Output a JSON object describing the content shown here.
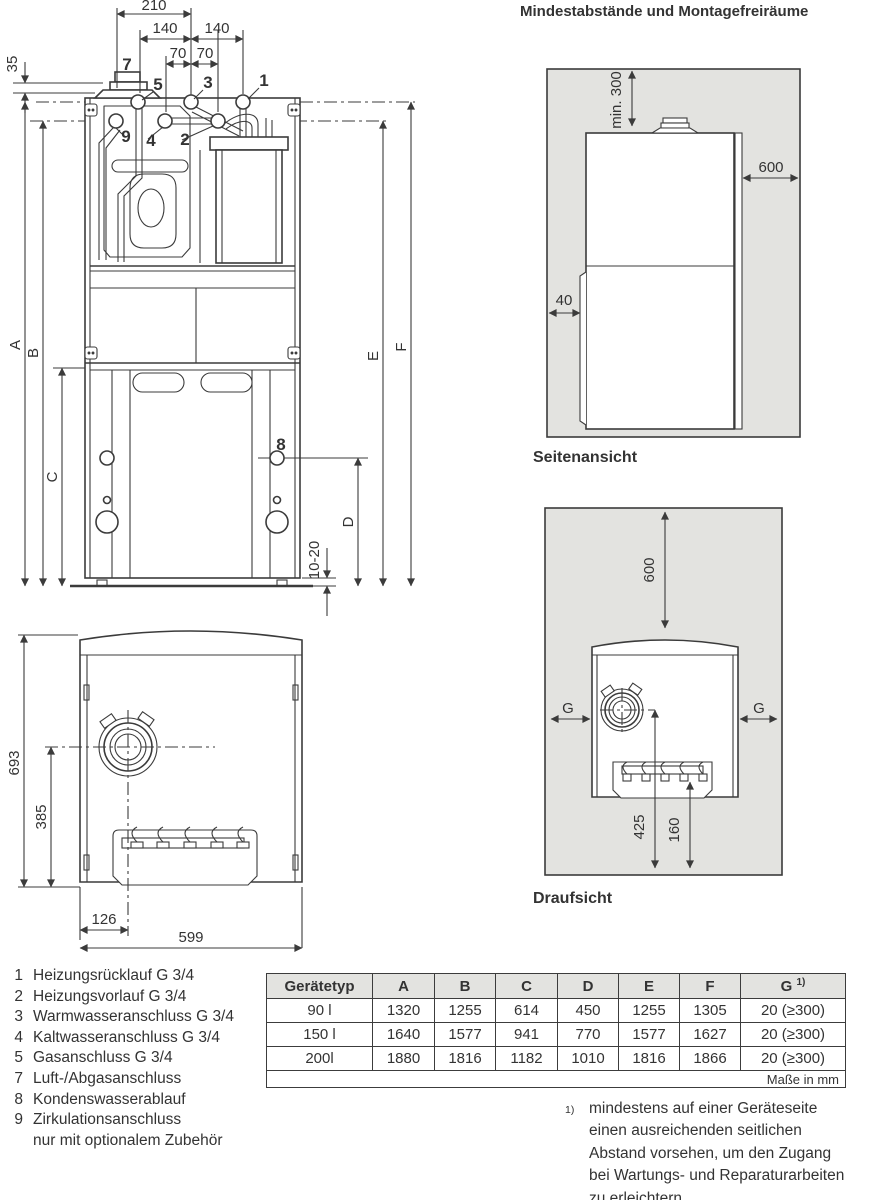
{
  "title": "Mindestabstände und Montagefreiräume",
  "front": {
    "d210": "210",
    "d140l": "140",
    "d140r": "140",
    "d70l": "70",
    "d70r": "70",
    "d35": "35",
    "d1020": "10-20",
    "dimA": "A",
    "dimB": "B",
    "dimC": "C",
    "dimD": "D",
    "dimE": "E",
    "dimF": "F",
    "c1": "1",
    "c2": "2",
    "c3": "3",
    "c4": "4",
    "c5": "5",
    "c7": "7",
    "c8": "8",
    "c9": "9"
  },
  "side": {
    "label": "Seitenansicht",
    "min300": "min. 300",
    "d600": "600",
    "d40": "40"
  },
  "topview": {
    "label": "Draufsicht",
    "d600": "600",
    "gLeft": "G",
    "gRight": "G",
    "d425": "425",
    "d160": "160"
  },
  "bottom": {
    "d693": "693",
    "d385": "385",
    "d126": "126",
    "d599": "599"
  },
  "legend": {
    "items": [
      {
        "n": "1",
        "t": "Heizungsrücklauf G 3/4"
      },
      {
        "n": "2",
        "t": "Heizungsvorlauf G 3/4"
      },
      {
        "n": "3",
        "t": "Warmwasseranschluss G 3/4"
      },
      {
        "n": "4",
        "t": "Kaltwasseranschluss G 3/4"
      },
      {
        "n": "5",
        "t": "Gasanschluss G 3/4"
      },
      {
        "n": "7",
        "t": "Luft-/Abgasanschluss"
      },
      {
        "n": "8",
        "t": "Kondenswasserablauf"
      },
      {
        "n": "9",
        "t": "Zirkulationsanschluss"
      }
    ],
    "cont": "nur mit optionalem Zubehör"
  },
  "table": {
    "col_type": "Gerätetyp",
    "cols": [
      "A",
      "B",
      "C",
      "D",
      "E",
      "F"
    ],
    "gcol": {
      "label": "G",
      "sup": "1)"
    },
    "rows": [
      {
        "t": "90 l",
        "v": [
          "1320",
          "1255",
          "614",
          "450",
          "1255",
          "1305",
          "20 (≥300)"
        ]
      },
      {
        "t": "150 l",
        "v": [
          "1640",
          "1577",
          "941",
          "770",
          "1577",
          "1627",
          "20 (≥300)"
        ]
      },
      {
        "t": "200l",
        "v": [
          "1880",
          "1816",
          "1182",
          "1010",
          "1816",
          "1866",
          "20 (≥300)"
        ]
      }
    ],
    "note": "Maße in mm"
  },
  "footnote": {
    "sup": "1)",
    "lines": [
      "mindestens auf einer Geräteseite",
      "einen ausreichenden seitlichen",
      "Abstand vorsehen, um den Zugang",
      "bei Wartungs- und Reparaturarbeiten",
      "zu erleichtern"
    ]
  },
  "colors": {
    "line": "#3b3b3b",
    "panel": "#e3e3e0",
    "text": "#333333"
  }
}
